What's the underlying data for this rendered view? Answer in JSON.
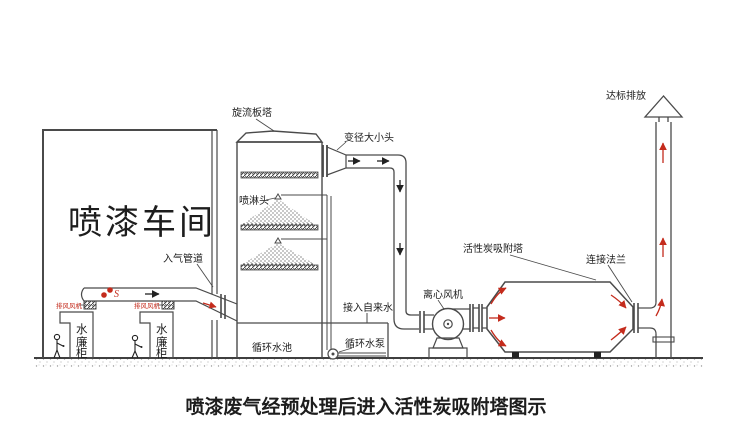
{
  "title": "喷漆废气经预处理后进入活性炭吸附塔图示",
  "workshop": {
    "name": "喷漆车间",
    "inlet_duct": "入气管道",
    "booth_fan": "排风风机",
    "flex_mark": "S",
    "cabinet": {
      "chars": [
        "水",
        "廉",
        "柜"
      ]
    }
  },
  "scrubber": {
    "tower": "旋流板塔",
    "reducer": "变径大小头",
    "spray_head": "喷淋头",
    "tap_water": "接入自来水",
    "pool": "循环水池",
    "pump": "循环水泵"
  },
  "adsorption": {
    "fan": "离心风机",
    "tower": "活性炭吸附塔",
    "flange": "连接法兰",
    "outlet": "达标排放"
  },
  "colors": {
    "line": "#4a4a4a",
    "accent_red": "#c42b1c"
  }
}
